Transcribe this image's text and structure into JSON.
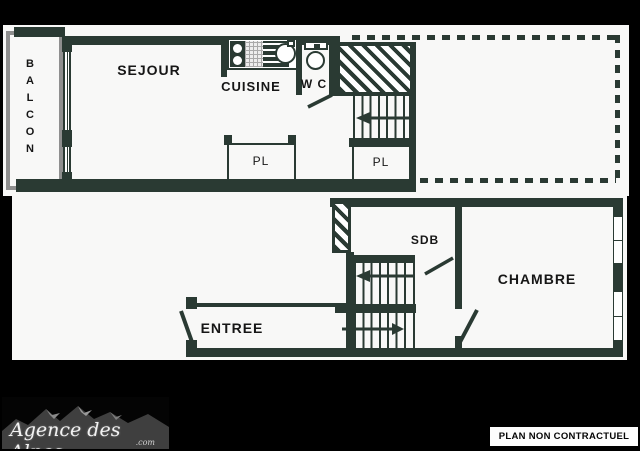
{
  "rooms": {
    "balcon": "BALCON",
    "sejour": "SEJOUR",
    "cuisine": "CUISINE",
    "wc": "W C",
    "pl": "PL",
    "sdb": "SDB",
    "chambre": "CHAMBRE",
    "entree": "ENTREE"
  },
  "footer": {
    "agency": "Agence des Alpes",
    "domain": ".com",
    "disclaimer": "PLAN NON CONTRACTUEL"
  },
  "colors": {
    "wall": "#2a3a33",
    "balcony_rail": "#8f8f8f",
    "paper": "#f8f8f7",
    "background": "#000000",
    "label": "#161616"
  }
}
